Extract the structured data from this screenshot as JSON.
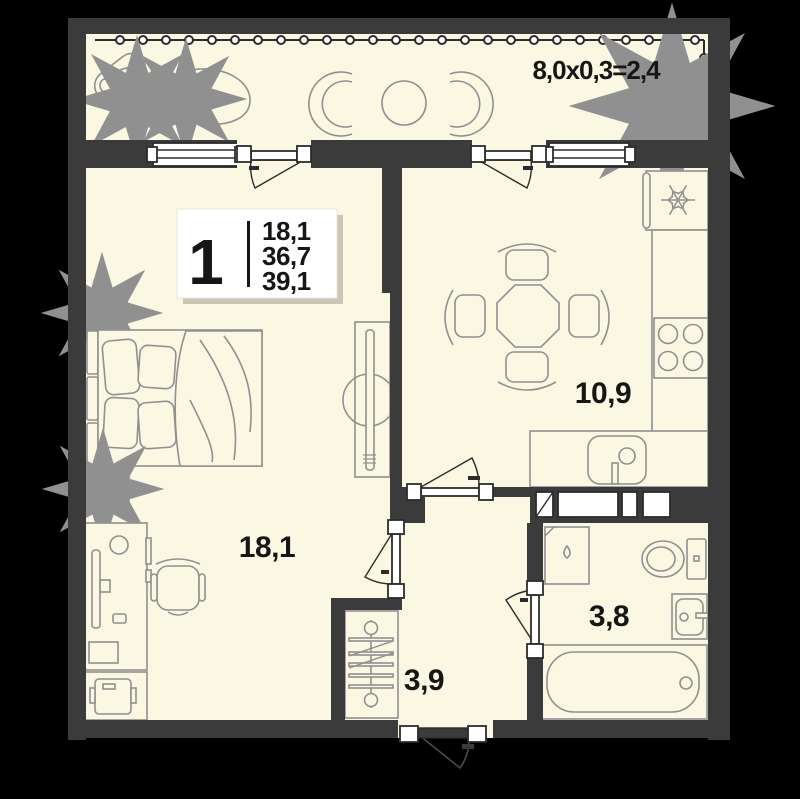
{
  "colors": {
    "background": "#000000",
    "wall": "#3b3b3b",
    "floor": "#faf7e2",
    "furniture_outline": "#909090",
    "text": "#161616",
    "info_box_bg": "#ffffff"
  },
  "balcony": {
    "dimension_label": "8,0x0,3=2,4"
  },
  "info_box": {
    "rooms_count": "1",
    "values": [
      "18,1",
      "36,7",
      "39,1"
    ]
  },
  "rooms": {
    "living_room": {
      "area": "18,1"
    },
    "kitchen": {
      "area": "10,9"
    },
    "hallway": {
      "area": "3,9"
    },
    "bathroom": {
      "area": "3,8"
    }
  }
}
